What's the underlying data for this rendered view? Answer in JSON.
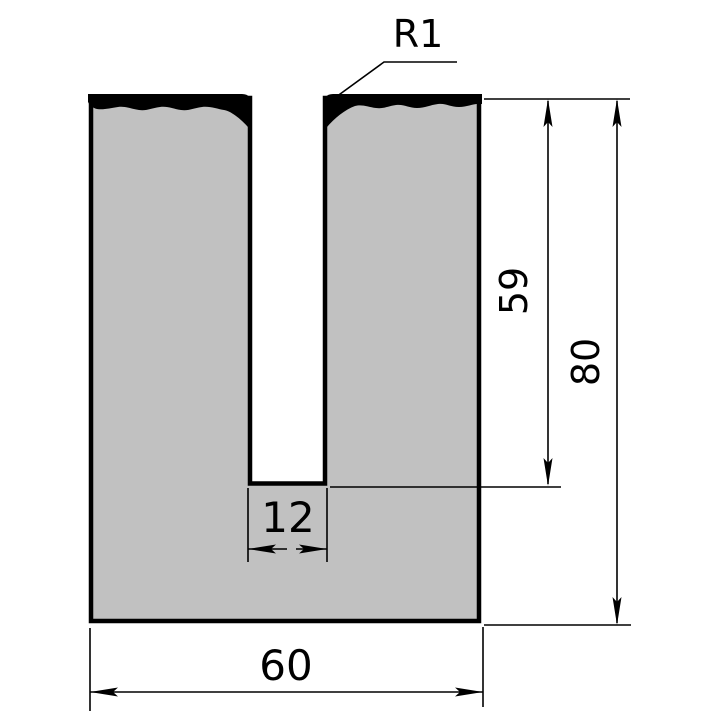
{
  "drawing": {
    "dimensions": {
      "radius_label": "R1",
      "slot_depth_label": "59",
      "total_height_label": "80",
      "slot_width_label": "12",
      "total_width_label": "60"
    },
    "colors": {
      "body_fill": "#c1c1c1",
      "outline": "#000000",
      "hardened_zone": "#000000",
      "background": "#ffffff"
    }
  }
}
